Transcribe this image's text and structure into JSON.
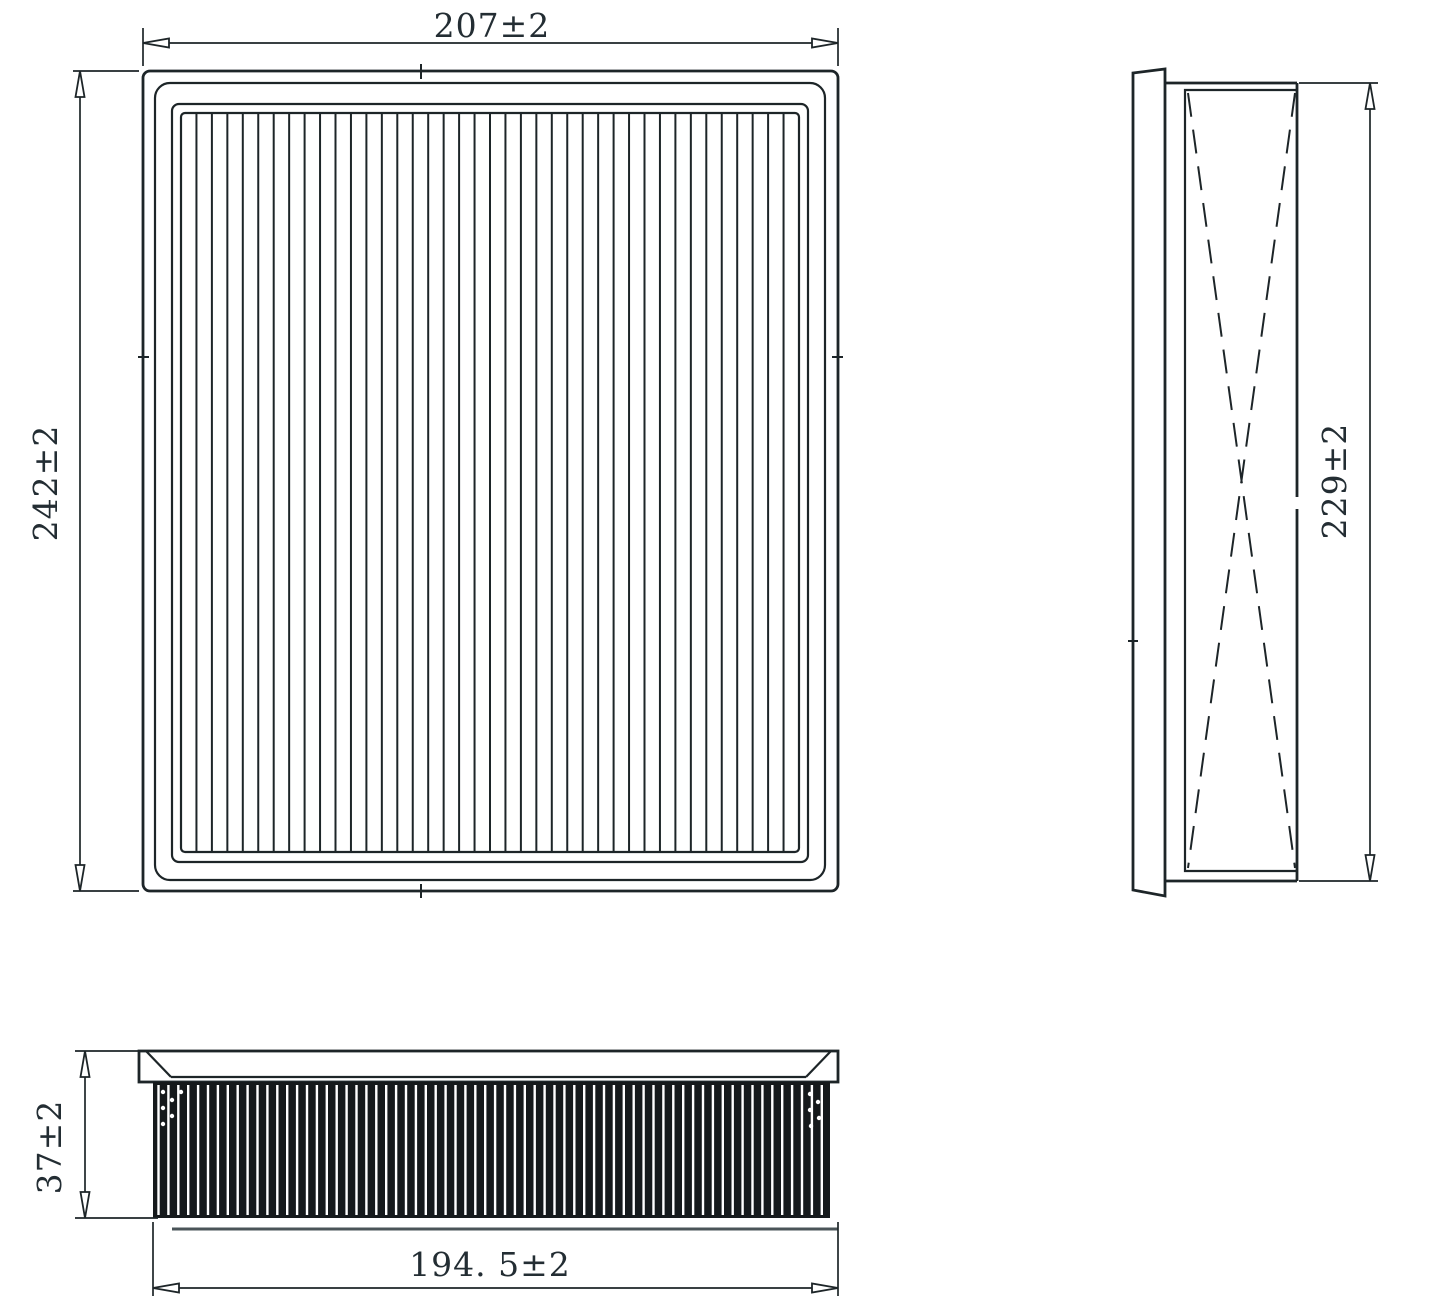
{
  "dimensions": {
    "front_width": "207±2",
    "front_height": "242±2",
    "side_height": "229±2",
    "profile_depth": "37±2",
    "profile_width": "194. 5±2"
  },
  "colors": {
    "line": "#1d2528",
    "text": "#232d33",
    "media_fill": "#15191b",
    "background": "#ffffff"
  }
}
